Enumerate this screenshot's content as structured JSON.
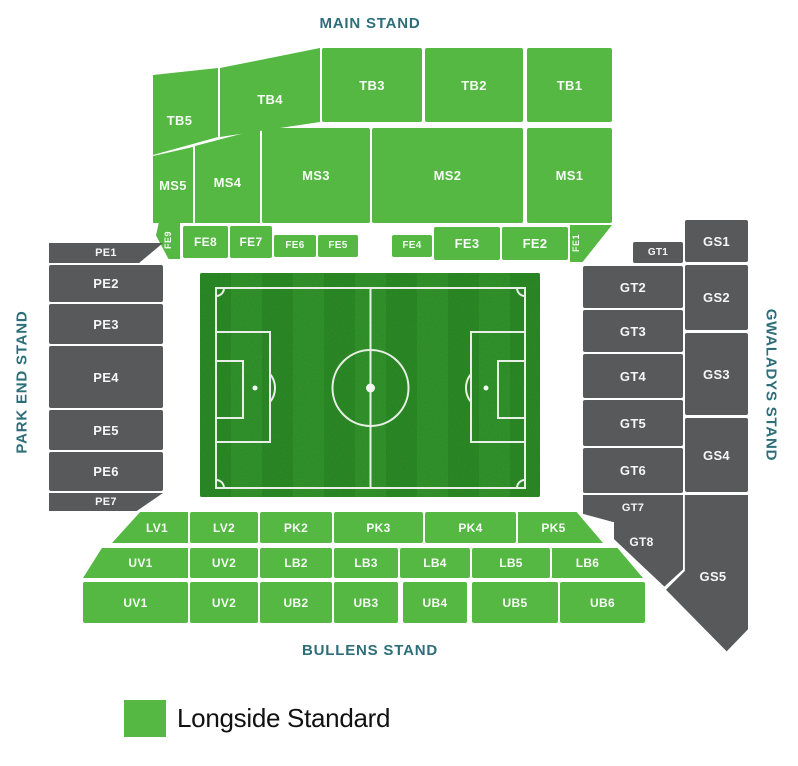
{
  "page": {
    "background": "#ffffff"
  },
  "stadium_map": {
    "stands": [
      {
        "id": "main",
        "label": "MAIN STAND",
        "position": "top"
      },
      {
        "id": "park_end",
        "label": "PARK END STAND",
        "position": "left"
      },
      {
        "id": "gwaladys",
        "label": "GWALADYS STAND",
        "position": "right"
      },
      {
        "id": "bullens",
        "label": "BULLENS STAND",
        "position": "bottom"
      }
    ],
    "sections": [
      {
        "id": "tb5",
        "label": "TB5",
        "stand": "MAIN STAND",
        "status": "longside-standard"
      },
      {
        "id": "tb4",
        "label": "TB4",
        "stand": "MAIN STAND",
        "status": "longside-standard"
      },
      {
        "id": "tb3",
        "label": "TB3",
        "stand": "MAIN STAND",
        "status": "longside-standard"
      },
      {
        "id": "tb2",
        "label": "TB2",
        "stand": "MAIN STAND",
        "status": "longside-standard"
      },
      {
        "id": "tb1",
        "label": "TB1",
        "stand": "MAIN STAND",
        "status": "longside-standard"
      },
      {
        "id": "ms5",
        "label": "MS5",
        "stand": "MAIN STAND",
        "status": "longside-standard"
      },
      {
        "id": "ms4",
        "label": "MS4",
        "stand": "MAIN STAND",
        "status": "longside-standard"
      },
      {
        "id": "ms3",
        "label": "MS3",
        "stand": "MAIN STAND",
        "status": "longside-standard"
      },
      {
        "id": "ms2",
        "label": "MS2",
        "stand": "MAIN STAND",
        "status": "longside-standard"
      },
      {
        "id": "ms1",
        "label": "MS1",
        "stand": "MAIN STAND",
        "status": "longside-standard"
      },
      {
        "id": "fe9",
        "label": "FE9",
        "stand": "MAIN STAND",
        "status": "longside-standard"
      },
      {
        "id": "fe8",
        "label": "FE8",
        "stand": "MAIN STAND",
        "status": "longside-standard"
      },
      {
        "id": "fe7",
        "label": "FE7",
        "stand": "MAIN STAND",
        "status": "longside-standard"
      },
      {
        "id": "fe6",
        "label": "FE6",
        "stand": "MAIN STAND",
        "status": "longside-standard"
      },
      {
        "id": "fe5",
        "label": "FE5",
        "stand": "MAIN STAND",
        "status": "longside-standard"
      },
      {
        "id": "fe4",
        "label": "FE4",
        "stand": "MAIN STAND",
        "status": "longside-standard"
      },
      {
        "id": "fe3",
        "label": "FE3",
        "stand": "MAIN STAND",
        "status": "longside-standard"
      },
      {
        "id": "fe2",
        "label": "FE2",
        "stand": "MAIN STAND",
        "status": "longside-standard"
      },
      {
        "id": "fe1",
        "label": "FE1",
        "stand": "MAIN STAND",
        "status": "longside-standard"
      },
      {
        "id": "pe1",
        "label": "PE1",
        "stand": "PARK END STAND",
        "status": "unavailable"
      },
      {
        "id": "pe2",
        "label": "PE2",
        "stand": "PARK END STAND",
        "status": "unavailable"
      },
      {
        "id": "pe3",
        "label": "PE3",
        "stand": "PARK END STAND",
        "status": "unavailable"
      },
      {
        "id": "pe4",
        "label": "PE4",
        "stand": "PARK END STAND",
        "status": "unavailable"
      },
      {
        "id": "pe5",
        "label": "PE5",
        "stand": "PARK END STAND",
        "status": "unavailable"
      },
      {
        "id": "pe6",
        "label": "PE6",
        "stand": "PARK END STAND",
        "status": "unavailable"
      },
      {
        "id": "pe7",
        "label": "PE7",
        "stand": "PARK END STAND",
        "status": "unavailable"
      },
      {
        "id": "gt1",
        "label": "GT1",
        "stand": "GWALADYS STAND",
        "status": "unavailable"
      },
      {
        "id": "gt2",
        "label": "GT2",
        "stand": "GWALADYS STAND",
        "status": "unavailable"
      },
      {
        "id": "gt3",
        "label": "GT3",
        "stand": "GWALADYS STAND",
        "status": "unavailable"
      },
      {
        "id": "gt4",
        "label": "GT4",
        "stand": "GWALADYS STAND",
        "status": "unavailable"
      },
      {
        "id": "gt5",
        "label": "GT5",
        "stand": "GWALADYS STAND",
        "status": "unavailable"
      },
      {
        "id": "gt6",
        "label": "GT6",
        "stand": "GWALADYS STAND",
        "status": "unavailable"
      },
      {
        "id": "gt7",
        "label": "GT7",
        "stand": "GWALADYS STAND",
        "status": "unavailable"
      },
      {
        "id": "gt8",
        "label": "GT8",
        "stand": "GWALADYS STAND",
        "status": "unavailable"
      },
      {
        "id": "gs1",
        "label": "GS1",
        "stand": "GWALADYS STAND",
        "status": "unavailable"
      },
      {
        "id": "gs2",
        "label": "GS2",
        "stand": "GWALADYS STAND",
        "status": "unavailable"
      },
      {
        "id": "gs3",
        "label": "GS3",
        "stand": "GWALADYS STAND",
        "status": "unavailable"
      },
      {
        "id": "gs4",
        "label": "GS4",
        "stand": "GWALADYS STAND",
        "status": "unavailable"
      },
      {
        "id": "gs5",
        "label": "GS5",
        "stand": "GWALADYS STAND",
        "status": "unavailable"
      },
      {
        "id": "lv1",
        "label": "LV1",
        "stand": "BULLENS STAND",
        "status": "longside-standard"
      },
      {
        "id": "lv2",
        "label": "LV2",
        "stand": "BULLENS STAND",
        "status": "longside-standard"
      },
      {
        "id": "pk2",
        "label": "PK2",
        "stand": "BULLENS STAND",
        "status": "longside-standard"
      },
      {
        "id": "pk3",
        "label": "PK3",
        "stand": "BULLENS STAND",
        "status": "longside-standard"
      },
      {
        "id": "pk4",
        "label": "PK4",
        "stand": "BULLENS STAND",
        "status": "longside-standard"
      },
      {
        "id": "pk5",
        "label": "PK5",
        "stand": "BULLENS STAND",
        "status": "longside-standard"
      },
      {
        "id": "uv1m",
        "label": "UV1",
        "stand": "BULLENS STAND",
        "status": "longside-standard"
      },
      {
        "id": "uv2m",
        "label": "UV2",
        "stand": "BULLENS STAND",
        "status": "longside-standard"
      },
      {
        "id": "lb2",
        "label": "LB2",
        "stand": "BULLENS STAND",
        "status": "longside-standard"
      },
      {
        "id": "lb3",
        "label": "LB3",
        "stand": "BULLENS STAND",
        "status": "longside-standard"
      },
      {
        "id": "lb4",
        "label": "LB4",
        "stand": "BULLENS STAND",
        "status": "longside-standard"
      },
      {
        "id": "lb5",
        "label": "LB5",
        "stand": "BULLENS STAND",
        "status": "longside-standard"
      },
      {
        "id": "lb6",
        "label": "LB6",
        "stand": "BULLENS STAND",
        "status": "longside-standard"
      },
      {
        "id": "uv1b",
        "label": "UV1",
        "stand": "BULLENS STAND",
        "status": "longside-standard"
      },
      {
        "id": "uv2b",
        "label": "UV2",
        "stand": "BULLENS STAND",
        "status": "longside-standard"
      },
      {
        "id": "ub2",
        "label": "UB2",
        "stand": "BULLENS STAND",
        "status": "longside-standard"
      },
      {
        "id": "ub3",
        "label": "UB3",
        "stand": "BULLENS STAND",
        "status": "longside-standard"
      },
      {
        "id": "ub4",
        "label": "UB4",
        "stand": "BULLENS STAND",
        "status": "longside-standard"
      },
      {
        "id": "ub5",
        "label": "UB5",
        "stand": "BULLENS STAND",
        "status": "longside-standard"
      },
      {
        "id": "ub6",
        "label": "UB6",
        "stand": "BULLENS STAND",
        "status": "longside-standard"
      }
    ]
  },
  "legend": {
    "items": [
      {
        "label": "Longside Standard",
        "status": "longside-standard",
        "color": "#55b843"
      }
    ]
  },
  "colors": {
    "longside_standard": "#55b843",
    "unavailable": "#58595b",
    "stand_label": "#2d6e79",
    "pitch_grass_dark": "#26731d",
    "pitch_grass_light": "#2e8026",
    "pitch_line": "#f2f5f1",
    "legend_text": "#111111"
  }
}
